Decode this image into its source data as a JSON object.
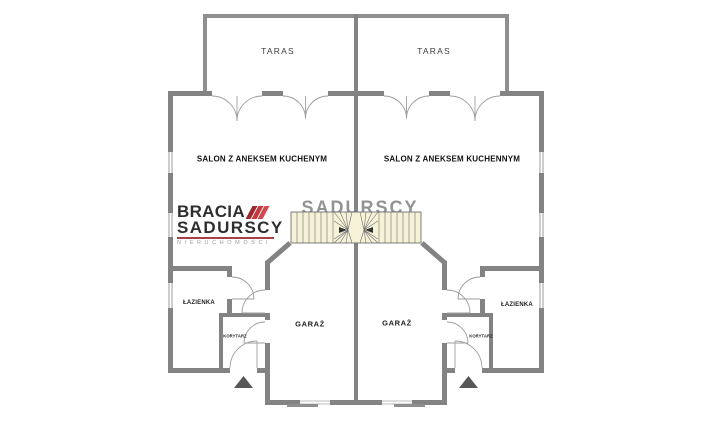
{
  "brand": {
    "line1": "BRACIA",
    "line2": "SADURSCY",
    "subtitle": "NIERUCHOMOŚCI",
    "ghost_text": "SADURSCY"
  },
  "rooms": {
    "terrace_left": "TARAS",
    "terrace_right": "TARAS",
    "living_left": "SALON Z ANEKSEM KUCHENYM",
    "living_right": "SALON Z ANEKSEM KUCHENNYM",
    "garage_left": "GARAŻ",
    "garage_right": "GARAŻ",
    "bathroom_left": "ŁAZIENKA",
    "bathroom_right": "ŁAZIENKA",
    "corridor_left": "KORYTARZ",
    "corridor_right": "KORYTARZ"
  },
  "colors": {
    "wall": "#838383",
    "terrace_wall": "#8f8f8f",
    "window": "#cdcdcd",
    "door_line": "#9e9e9e",
    "stairs_fill": "#f6f2d8",
    "stairs_line": "#6f6f6f",
    "stairs_arrow": "#333333",
    "entrance_triangle": "#575757",
    "brand_accent": "#c43a40",
    "brand_text": "#2e2e2e",
    "brand_subtitle": "#9b9b9b"
  }
}
